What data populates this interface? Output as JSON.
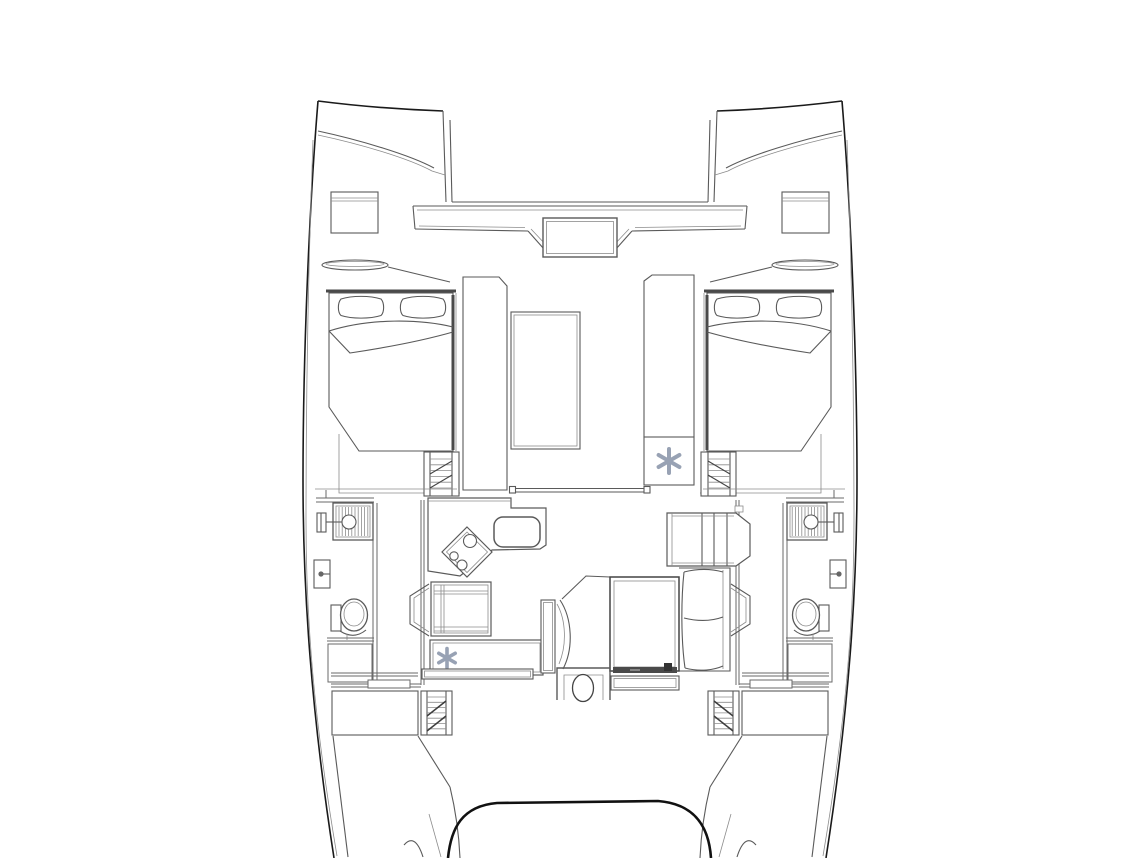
{
  "canvas": {
    "width": 1144,
    "height": 858,
    "background_color": "#ffffff"
  },
  "style": {
    "line_color": "#5a5a5a",
    "outline_color": "#1a1a1a",
    "detail_line_color": "#8c8c8c",
    "wall_color": "#6a6a6a",
    "dark_fill": "#4a4a4a",
    "ac_icon_color": "#98a2b4"
  },
  "icons": {
    "ac_snowflake": {
      "name": "ac-snowflake-icon",
      "glyph": "✻",
      "color": "#98a2b4",
      "instances": 2
    }
  },
  "components": [
    "port-bow",
    "starboard-bow",
    "trampoline",
    "forward-crossbeam",
    "anchor-locker-seat",
    "foredeck-hatch",
    "bow-locker-lid",
    "port-forward-cabin-berth",
    "starboard-forward-cabin-berth",
    "berth-pillows",
    "companionway-steps",
    "forward-salon-panels",
    "salon-skylight",
    "salon-sliding-door",
    "air-conditioning-unit",
    "galley-counter",
    "stove",
    "sink",
    "refrigerator-cabinet",
    "galley-aft-counter",
    "nav-chair",
    "dinette-bench",
    "dinette-sofa",
    "dinette-table",
    "table-step",
    "helm-seat",
    "port-head-shower",
    "port-shower-head",
    "port-toilet",
    "port-porthole",
    "starboard-head-shower",
    "starboard-toilet",
    "starboard-porthole",
    "aft-deck-locker",
    "aft-companionway-steps",
    "aft-door-unit",
    "stern-steps",
    "transom-platform"
  ]
}
